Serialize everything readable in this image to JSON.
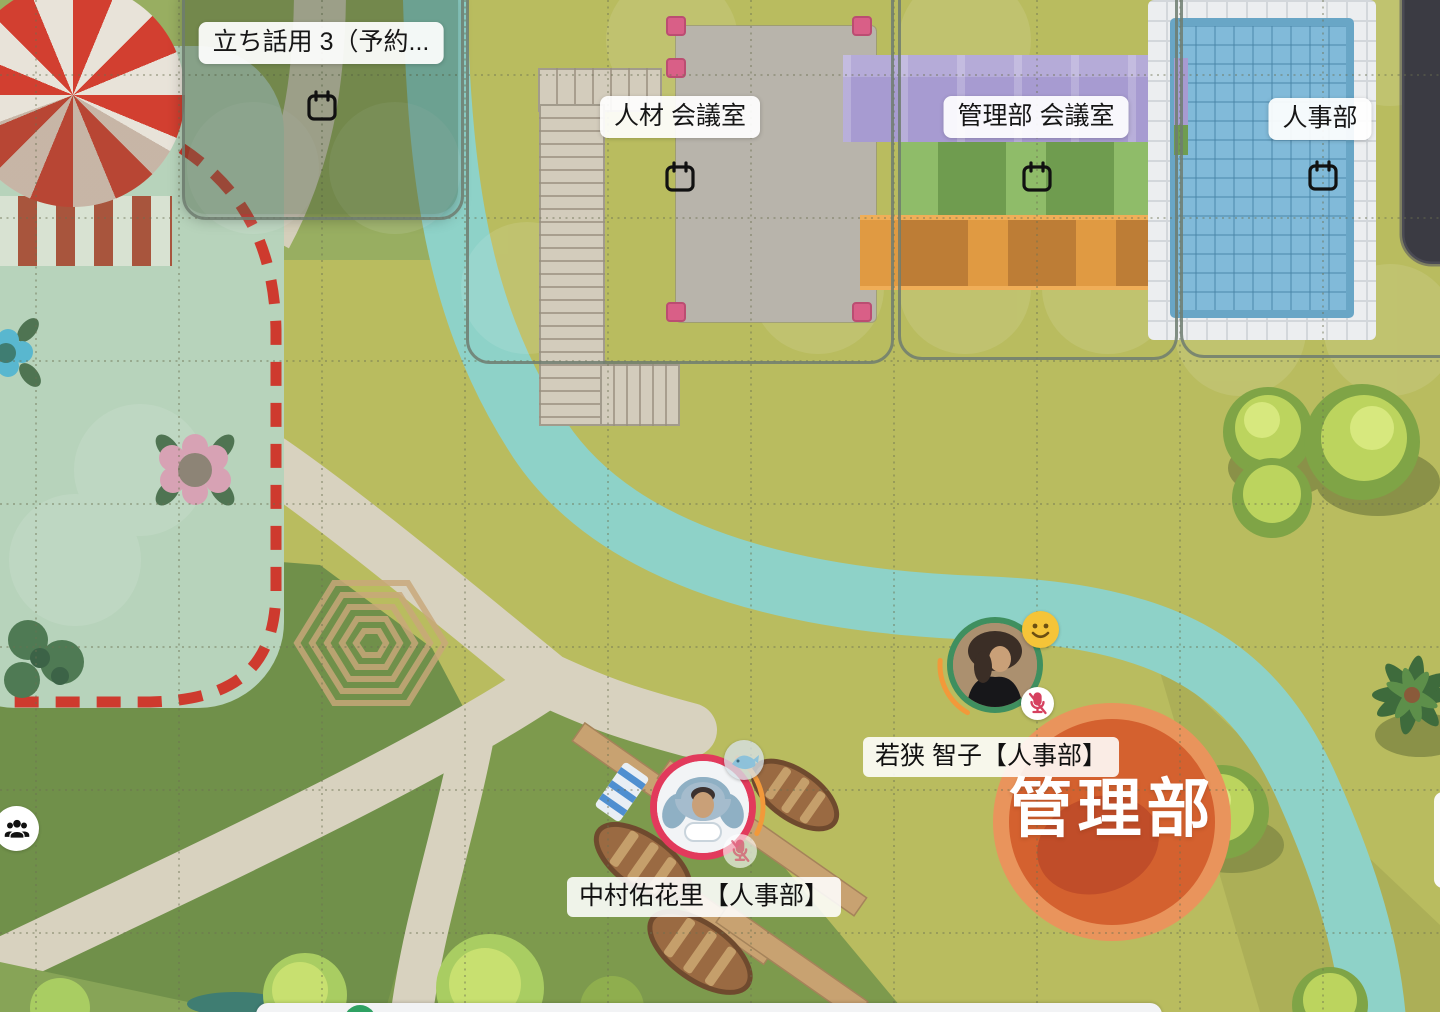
{
  "app": {
    "type": "virtual-office-map"
  },
  "zones": [
    {
      "label": "立ち話用 3（予約...",
      "icon": "calendar"
    },
    {
      "label": "人材 会議室",
      "icon": "calendar"
    },
    {
      "label": "管理部 会議室",
      "icon": "calendar"
    },
    {
      "label": "人事部",
      "icon": "calendar"
    }
  ],
  "ground_decal": {
    "label": "管理部",
    "color": "#d4612f"
  },
  "users": [
    {
      "label": "若狭 智子【人事部】",
      "ring_color": "#3f8f5f",
      "badges": [
        "smiley",
        "mic-muted"
      ]
    },
    {
      "label": "中村佑花里【人事部】",
      "ring_color": "#e23a5c",
      "badges": [
        "whale",
        "mic-muted"
      ]
    }
  ],
  "hud": {
    "people_counter_icon": "group-of-people"
  },
  "colors": {
    "grass_olive": "#b9bc5f",
    "grass_green": "#7d9a4d",
    "grass_dark": "#70904a",
    "mint_zone": "#b7d3bb",
    "dashed_border": "#ce3a2e",
    "river": "#8ed2c8",
    "path": "#d8d2bf",
    "pool_water": "#81bad9",
    "purple_carpet": "#a79bd1",
    "green_shelf": "#6f9c4f",
    "orange_shelf": "#e09a42",
    "decal_orange": "#d4612f",
    "label_bg": "#ffffff",
    "marker_pink": "#d95f87"
  }
}
